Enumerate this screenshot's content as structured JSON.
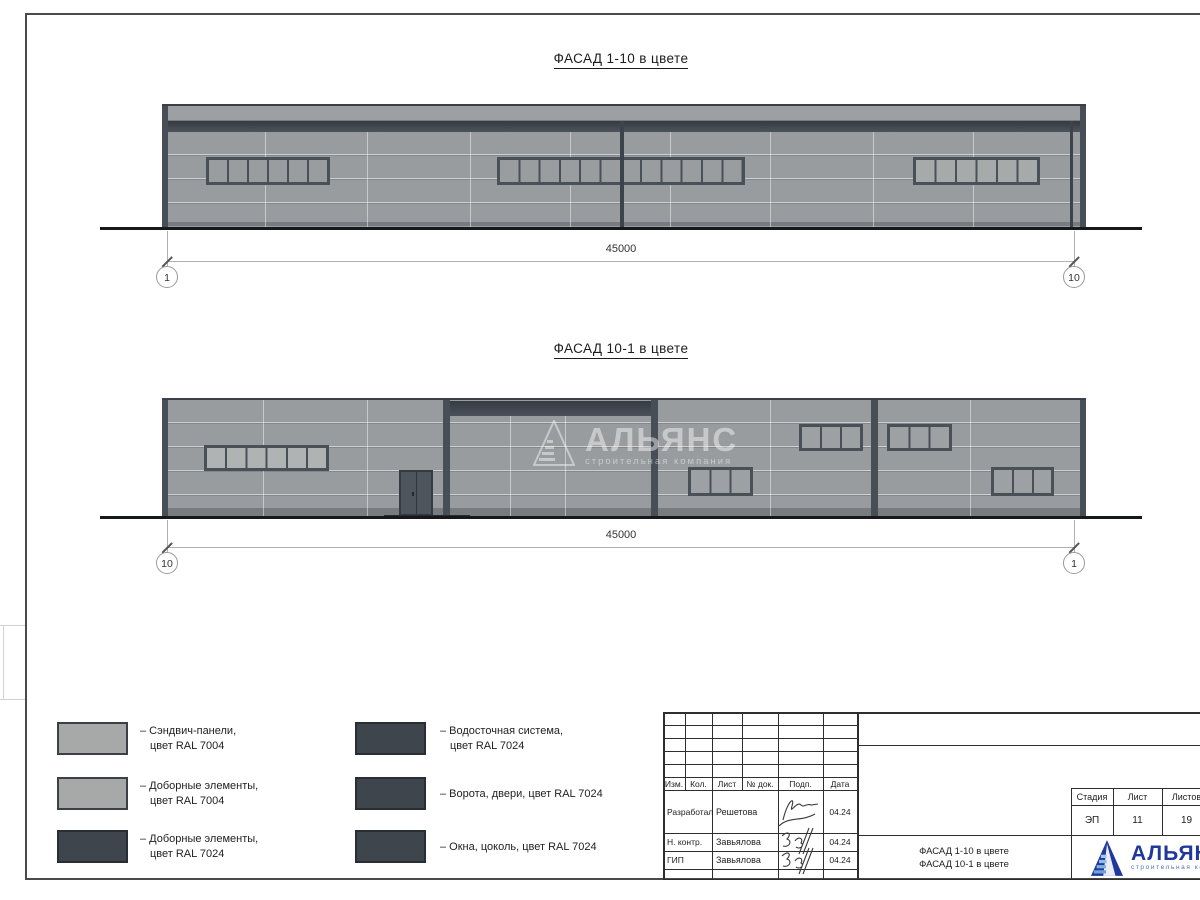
{
  "titles": {
    "facade1": "ФАСАД 1-10 в цвете",
    "facade2": "ФАСАД 10-1 в цвете"
  },
  "facade1": {
    "dimension": "45000",
    "axis_left": "1",
    "axis_right": "10"
  },
  "facade2": {
    "dimension": "45000",
    "axis_left": "10",
    "axis_right": "1"
  },
  "watermark": {
    "name": "АЛЬЯНС",
    "subtitle": "строительная компания"
  },
  "legend": {
    "items": [
      {
        "swatch": "ral7004",
        "line1": "– Сэндвич-панели,",
        "line2": "цвет RAL 7004"
      },
      {
        "swatch": "ral7004",
        "line1": "– Доборные элементы,",
        "line2": "цвет RAL 7004"
      },
      {
        "swatch": "ral7024",
        "line1": "– Доборные элементы,",
        "line2": "цвет RAL 7024"
      },
      {
        "swatch": "ral7024",
        "line1": "– Водосточная система,",
        "line2": "цвет RAL 7024"
      },
      {
        "swatch": "ral7024",
        "line1": "– Ворота, двери, цвет RAL 7024",
        "line2": ""
      },
      {
        "swatch": "ral7024",
        "line1": "– Окна, цоколь, цвет RAL 7024",
        "line2": ""
      }
    ]
  },
  "colors": {
    "ral7004": "#a6a9a8",
    "ral7024": "#3f454d",
    "logo_blue": "#20389b"
  },
  "titleblock": {
    "columns": [
      "Изм.",
      "Кол.",
      "Лист",
      "№ док.",
      "Подп.",
      "Дата"
    ],
    "rows": [
      {
        "role": "Разработал",
        "name": "Решетова",
        "date": "04.24"
      },
      {
        "role": "Н. контр.",
        "name": "Завьялова",
        "date": "04.24"
      },
      {
        "role": "ГИП",
        "name": "Завьялова",
        "date": "04.24"
      }
    ],
    "doc_title_line1": "ФАСАД 1-10 в цвете",
    "doc_title_line2": "ФАСАД 10-1 в цвете",
    "stage_header": "Стадия",
    "sheet_header": "Лист",
    "sheets_header": "Листов",
    "stage": "ЭП",
    "sheet": "11",
    "sheets": "19",
    "logo_name": "АЛЬЯНС",
    "logo_subtitle": "строительная компания"
  }
}
